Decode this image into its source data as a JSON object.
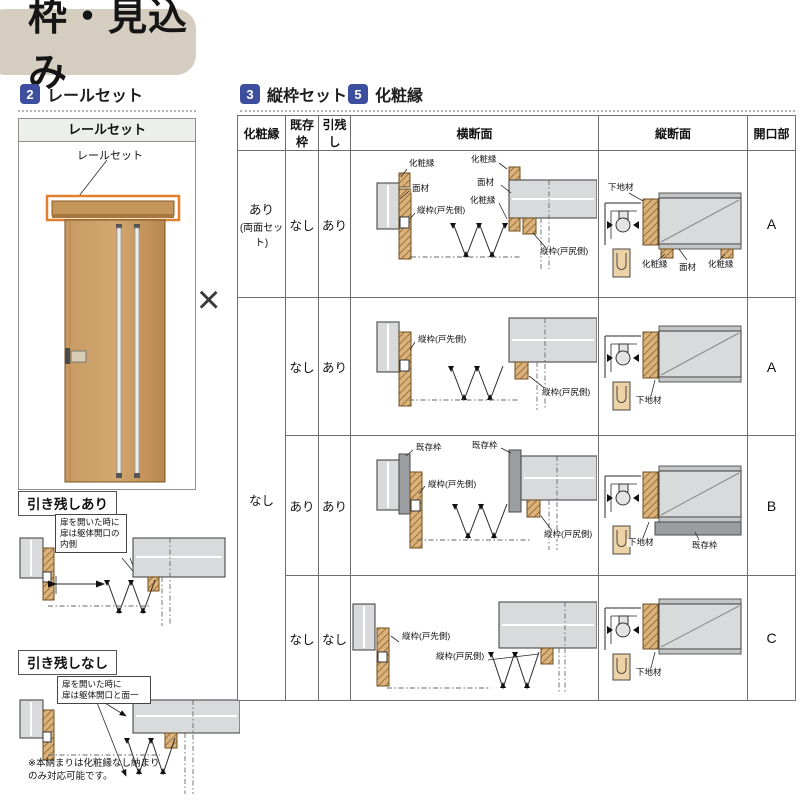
{
  "title": "枠・見込み",
  "sections": {
    "rail": {
      "num": "2",
      "label": "レールセット"
    },
    "tatewaku": {
      "num": "3",
      "label": "縦枠セット"
    },
    "kesho": {
      "num": "5",
      "label": "化粧縁"
    }
  },
  "door_panel": {
    "header": "レールセット",
    "callout": "レールセット"
  },
  "multiply": "×",
  "hikinokoshi": {
    "ari": {
      "title": "引き残しあり",
      "bubble_lines": [
        "扉を開いた時に",
        "扉は躯体開口の",
        "内側"
      ]
    },
    "nashi": {
      "title": "引き残しなし",
      "bubble_lines": [
        "扉を開いた時に",
        "扉は躯体開口と面一"
      ],
      "note_lines": [
        "※本納まりは化粧縁なし納まり",
        "のみ対応可能です。"
      ]
    }
  },
  "table": {
    "headers": [
      "化粧縁",
      "既存枠",
      "引残し",
      "横断面",
      "縦断面",
      "開口部"
    ],
    "rows": [
      {
        "kesho": "あり",
        "kesho_sub": "(両面セット)",
        "kison": "なし",
        "hiki": "あり",
        "opening": "A"
      },
      {
        "kesho": "なし",
        "kison": "なし",
        "hiki": "あり",
        "opening": "A"
      },
      {
        "kison": "あり",
        "hiki": "あり",
        "opening": "B"
      },
      {
        "kison": "なし",
        "hiki": "なし",
        "opening": "C"
      }
    ],
    "labels": {
      "kesho": "化粧縁",
      "menzai": "面材",
      "tatewaku_saki": "縦枠(戸先側)",
      "tatewaku_shiri": "縦枠(戸尻側)",
      "kison": "既存枠",
      "shitaji": "下地材"
    }
  }
}
